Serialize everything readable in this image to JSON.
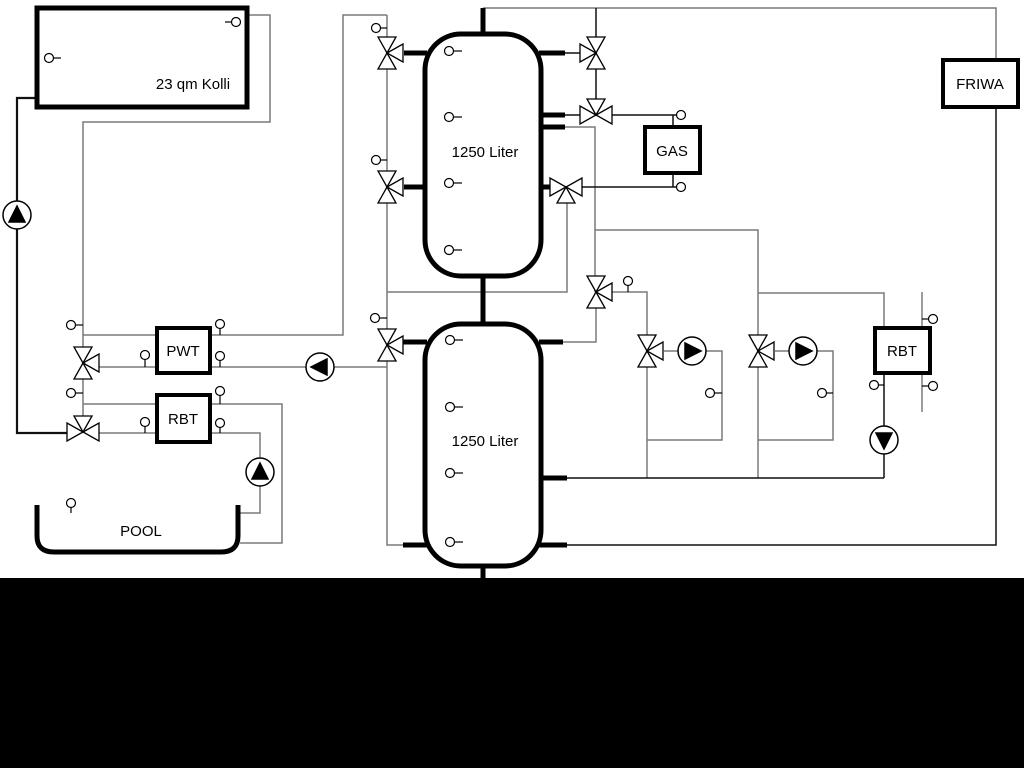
{
  "diagram": {
    "title": "Heating / solar / pool hydraulic schematic",
    "labels": {
      "collector": "23 qm Kolli",
      "tank_top": "1250 Liter",
      "tank_bottom": "1250 Liter",
      "gas": "GAS",
      "friwa": "FRIWA",
      "pwt": "PWT",
      "rbt_left": "RBT",
      "rbt_right": "RBT",
      "pool": "POOL"
    },
    "colors": {
      "background": "#ffffff",
      "pipe_gray": "#7a7a7a",
      "pipe_black": "#111111",
      "component_stroke": "#000000",
      "component_fill": "#ffffff",
      "letterbox": "#000000"
    },
    "component_counts": {
      "three_way_valves": 11,
      "pumps": 6,
      "sensors": 24,
      "storage_tanks": 2
    }
  }
}
